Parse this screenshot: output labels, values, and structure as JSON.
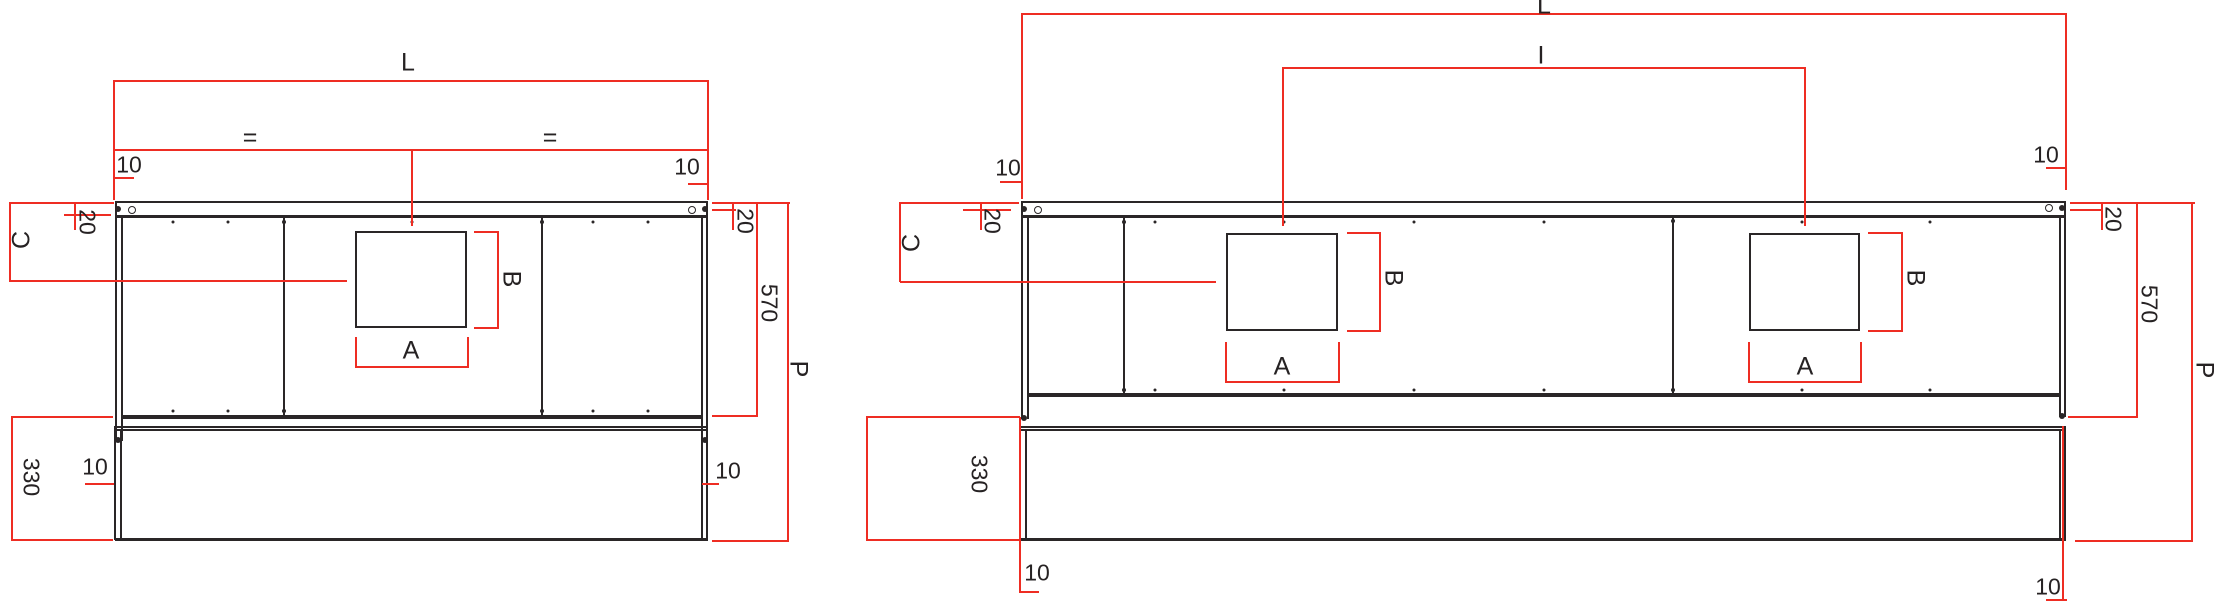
{
  "drawing": {
    "type": "technical-dimension-drawing",
    "views": 2,
    "colors": {
      "dimension_lines": "#ee2d23",
      "structure_lines": "#2a2627",
      "background": "#ffffff"
    }
  },
  "left_view": {
    "description": "unit with single centered opening",
    "labels": {
      "length": "L",
      "eq_left": "=",
      "eq_right": "=",
      "inset_top_left": "10",
      "inset_top_right": "10",
      "rail_left": "20",
      "rail_right": "20",
      "top_to_opening": "C",
      "opening_height": "B",
      "opening_width": "A",
      "body_height": "570",
      "total_height": "P",
      "lower_height": "330",
      "panel_left": "10",
      "panel_right": "10"
    }
  },
  "right_view": {
    "description": "unit with two openings spaced I apart",
    "labels": {
      "length": "L",
      "spacing": "I",
      "inset_top_left": "10",
      "inset_top_right": "10",
      "rail_left": "20",
      "rail_right": "20",
      "top_to_opening": "C",
      "opening1_height": "B",
      "opening1_width": "A",
      "opening2_height": "B",
      "opening2_width": "A",
      "body_height": "570",
      "total_height": "P",
      "lower_height": "330",
      "panel_left": "10",
      "panel_right": "10"
    }
  }
}
